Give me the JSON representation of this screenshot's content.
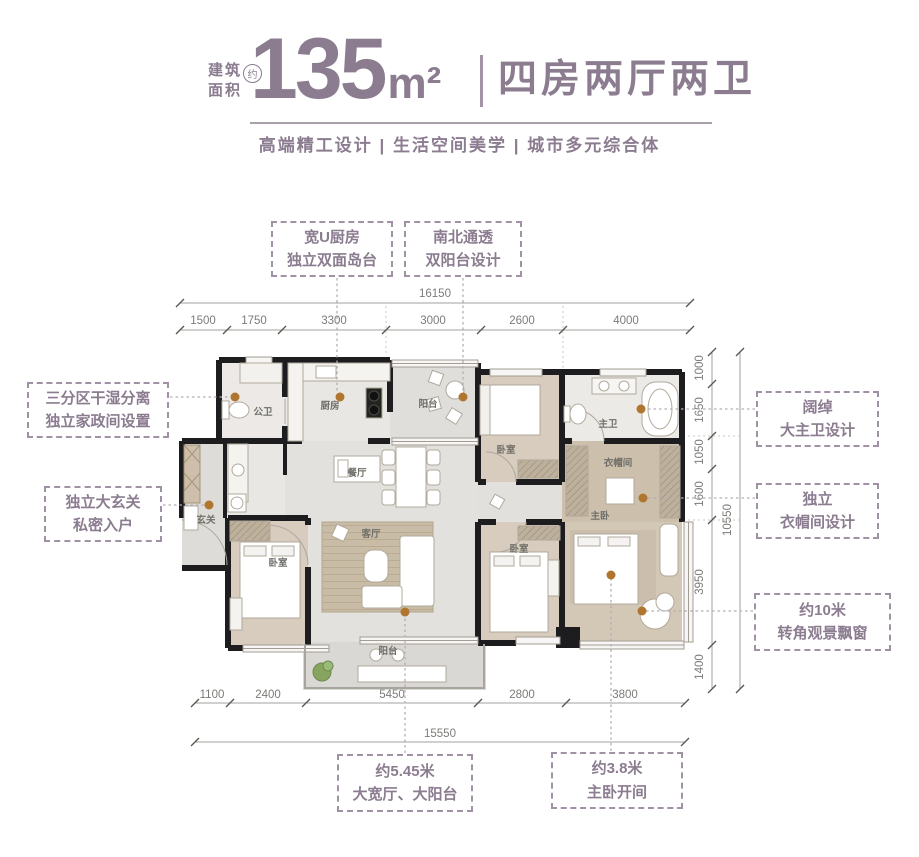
{
  "header": {
    "area_label_line1": "建筑",
    "area_label_line2": "面积",
    "approx_badge": "约",
    "area_value": "135",
    "area_unit": "m²",
    "layout_title": "四房两厅两卫",
    "subtitle": "高端精工设计 | 生活空间美学 | 城市多元综合体"
  },
  "callouts": {
    "kitchen": {
      "line1": "宽U厨房",
      "line2": "独立双面岛台"
    },
    "balcony_north": {
      "line1": "南北通透",
      "line2": "双阳台设计"
    },
    "laundry": {
      "line1": "三分区干湿分离",
      "line2": "独立家政间设置"
    },
    "foyer": {
      "line1": "独立大玄关",
      "line2": "私密入户"
    },
    "master_bath": {
      "line1": "阔绰",
      "line2": "大主卫设计"
    },
    "cloakroom": {
      "line1": "独立",
      "line2": "衣帽间设计"
    },
    "bay_window": {
      "line1": "约10米",
      "line2": "转角观景飘窗"
    },
    "living": {
      "line1": "约5.45米",
      "line2": "大宽厅、大阳台"
    },
    "master_bed": {
      "line1": "约3.8米",
      "line2": "主卧开间"
    }
  },
  "rooms": {
    "guest_bath": "公卫",
    "kitchen": "厨房",
    "balcony_north": "阳台",
    "bedroom_north": "卧室",
    "master_bath": "主卫",
    "cloakroom": "衣帽间",
    "dining": "餐厅",
    "foyer": "玄关",
    "master_bedroom": "主卧",
    "bedroom_west": "卧室",
    "living": "客厅",
    "bedroom_south": "卧室",
    "balcony_south": "阳台"
  },
  "dimensions": {
    "top": {
      "total": "16150",
      "segments": [
        "1500",
        "1750",
        "3300",
        "3000",
        "2600",
        "4000"
      ]
    },
    "right": {
      "total": "10550",
      "segments": [
        "1000",
        "1650",
        "1050",
        "1600",
        "3950",
        "1400"
      ]
    },
    "bottom": {
      "total": "15550",
      "segments": [
        "1100",
        "2400",
        "5450",
        "2800",
        "3800"
      ]
    }
  },
  "colors": {
    "accent_purple": "#8b7c90",
    "dimension_gray": "#7b7b78",
    "wall_black": "#1d1d1f",
    "leader_dot_orange": "#b0762f",
    "wood_floor": "#d7ccbd",
    "plant_green": "#87a55f"
  }
}
